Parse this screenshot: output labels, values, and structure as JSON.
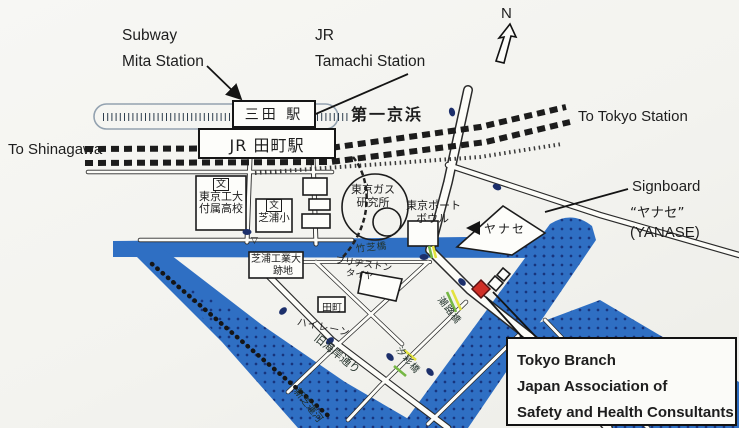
{
  "compass": {
    "n": "N"
  },
  "annotations": {
    "subway": "Subway",
    "mita": "Mita Station",
    "jr": "JR",
    "tamachi": "Tamachi Station",
    "to_tokyo": "To Tokyo Station",
    "to_shinagawa": "To Shinagawa",
    "signboard": "Signboard",
    "signboard_jp": "“ヤナセ”",
    "signboard_en": "(YANASE)"
  },
  "stations": {
    "mita_jp": "三田 駅",
    "tamachi_jp": "JR 田町駅"
  },
  "roads": {
    "daiichi_keihin": "第一京浜",
    "kyu_kaigan_dori": "旧海岸通り"
  },
  "places": {
    "tokyo_tech_hs": [
      "文",
      "東京工大",
      "付属高校"
    ],
    "shibaura_es": [
      "文",
      "芝浦小"
    ],
    "tokyo_gas": [
      "東京ガス",
      "研究所"
    ],
    "port_bowl": [
      "東京ポート",
      "ボウル"
    ],
    "yanase": "ヤナセ",
    "shibaura_tech": [
      "芝浦工業大",
      "跡地"
    ],
    "bridgestone": [
      "ブリヂストン",
      "タイヤ"
    ],
    "tamachi_hilane": [
      "田町",
      "ハイレーン"
    ]
  },
  "bridges": {
    "takeshiba": "竹芝橋",
    "shioji": "潮路橋",
    "shiosai": "汐彩橋",
    "canal": "新芝運河"
  },
  "marks": {
    "triangle": "▽"
  },
  "destination_box": {
    "line1": "Tokyo Branch",
    "line2": "Japan Association of",
    "line3": "Safety and Health Consultants"
  },
  "colors": {
    "canal-blue": "#2f6fc3",
    "canal-dot": "#17357e",
    "marker-red": "#cf2f26",
    "route-yellow": "#e3e23e",
    "route-green": "#76b845",
    "ink": "#1c1c1c",
    "signal-navy": "#1c2f6b",
    "paper": "#f4f4f0"
  }
}
